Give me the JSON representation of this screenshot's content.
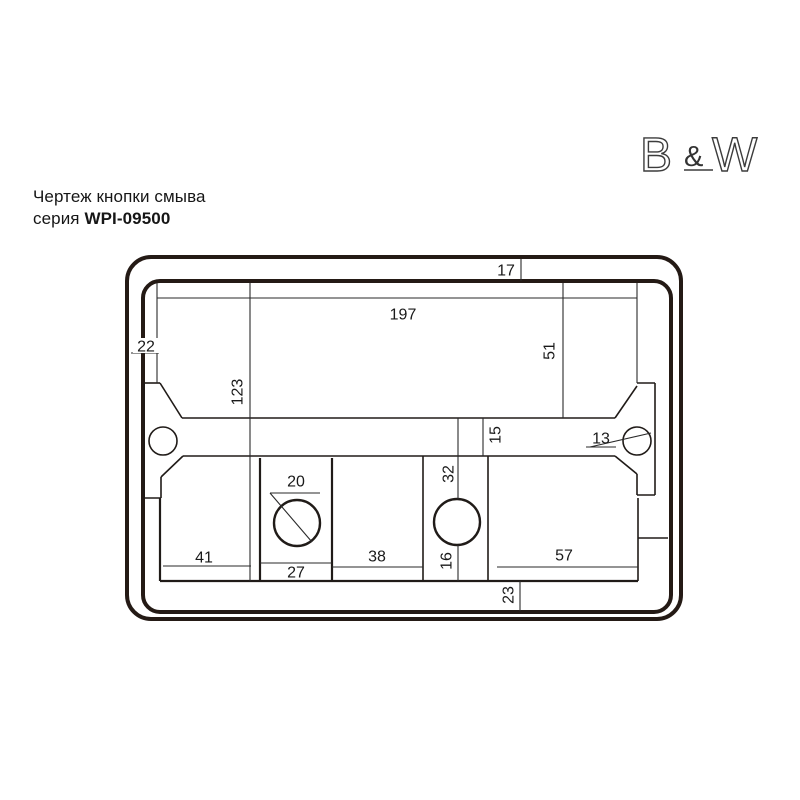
{
  "brand": {
    "letter_b": "B",
    "ampersand": "&",
    "letter_w": "W"
  },
  "title": {
    "line1": "Чертеж кнопки смыва",
    "series_prefix": "серия ",
    "series_model": "WPI-09500"
  },
  "drawing": {
    "dimensions": {
      "frame_top_17": "17",
      "width_197": "197",
      "offset_left_22": "22",
      "height_right_51": "51",
      "height_left_123": "123",
      "bar_height_15": "15",
      "hole_diameter_13": "13",
      "circle_top_offset_32": "32",
      "button_diameter_20": "20",
      "cell_width_41": "41",
      "cell_width_27": "27",
      "cell_width_38": "38",
      "circle_bottom_offset_16": "16",
      "cell_width_57": "57",
      "bottom_offset_23": "23"
    },
    "colors": {
      "plate_outline": "#241a15",
      "thin_line": "#2a2a2a",
      "text": "#1a1a1a",
      "background": "#ffffff"
    }
  }
}
